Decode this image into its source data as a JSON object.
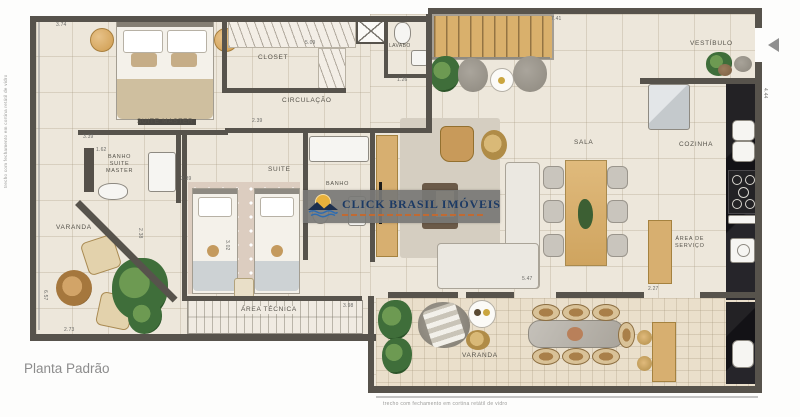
{
  "page": {
    "title_label": "Planta Padrão"
  },
  "watermark": {
    "brand": "CLICK BRASIL IMÓVEIS"
  },
  "captions": {
    "left_vertical": "trecho com fechamento em cortina retátil de vidro",
    "bottom": "trecho com fechamento em cortina retátil de vidro"
  },
  "rooms": {
    "suite_master": "SUITE MASTER",
    "closet": "CLOSET",
    "lavabo": "LAVABO",
    "circulacao": "CIRCULAÇÃO",
    "vestibulo": "VESTÍBULO",
    "sala": "SALA",
    "cozinha": "COZINHA",
    "banho_suite_master": "BANHO\nSUITE\nMASTER",
    "suite": "SUITE",
    "banho": "BANHO",
    "varanda_left": "VARANDA",
    "area_tecnica": "ÁREA TÉCNICA",
    "area_servico": "ÁREA DE\nSERVIÇO",
    "varanda_bottom": "VARANDA"
  },
  "dimensions": [
    {
      "text": "3.74",
      "x": 56,
      "y": 22,
      "vertical": false
    },
    {
      "text": "5.09",
      "x": 305,
      "y": 40,
      "vertical": false
    },
    {
      "text": "1.26",
      "x": 397,
      "y": 77,
      "vertical": false
    },
    {
      "text": "7.41",
      "x": 551,
      "y": 16,
      "vertical": false
    },
    {
      "text": "4.44",
      "x": 768,
      "y": 88,
      "vertical": true
    },
    {
      "text": "3.39",
      "x": 83,
      "y": 134,
      "vertical": false
    },
    {
      "text": "1.62",
      "x": 96,
      "y": 147,
      "vertical": false
    },
    {
      "text": "2.39",
      "x": 181,
      "y": 176,
      "vertical": false
    },
    {
      "text": "3.02",
      "x": 230,
      "y": 240,
      "vertical": true
    },
    {
      "text": "2.38",
      "x": 143,
      "y": 228,
      "vertical": true
    },
    {
      "text": "6.57",
      "x": 48,
      "y": 290,
      "vertical": true
    },
    {
      "text": "2.73",
      "x": 64,
      "y": 327,
      "vertical": false
    },
    {
      "text": "3.98",
      "x": 343,
      "y": 303,
      "vertical": false
    },
    {
      "text": "5.47",
      "x": 522,
      "y": 276,
      "vertical": false
    },
    {
      "text": "2.27",
      "x": 648,
      "y": 286,
      "vertical": false
    },
    {
      "text": "2.39",
      "x": 252,
      "y": 118,
      "vertical": false
    }
  ],
  "colors": {
    "wall": "#57534c",
    "floor": "#ede7db",
    "wood": "#d7af70",
    "counter_black": "#1a191c",
    "plant_green": "#3f6e3a",
    "brand_navy": "#1c3a64",
    "brand_sun": "#e8b13c",
    "brand_water": "#2e6cb0",
    "brand_tagline": "#c06a33"
  }
}
